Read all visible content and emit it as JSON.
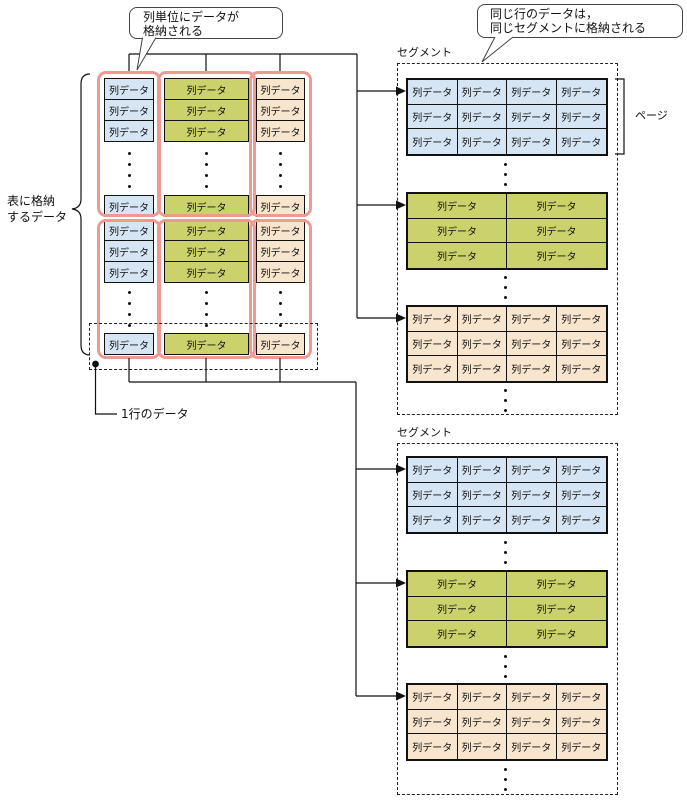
{
  "diagram": {
    "cell_label": "列データ",
    "page_label": "ページ",
    "row_label": "1行のデータ",
    "table_label": {
      "lines": [
        "表に格納",
        "するデータ"
      ]
    },
    "callout_column_storage": {
      "lines": [
        "列単位にデータが",
        "格納される"
      ]
    },
    "callout_segment_storage": {
      "lines": [
        "同じ行のデータは，",
        "同じセグメントに格納される"
      ]
    },
    "colors": {
      "column1": "#d5e5f4",
      "column2": "#cbd26b",
      "column3": "#f7e5cd",
      "highlight_outline": "#ef9a91",
      "line": "#111111"
    },
    "table": {
      "columns": [
        {
          "color_key": "column1"
        },
        {
          "color_key": "column2"
        },
        {
          "color_key": "column3"
        }
      ],
      "row_groups": [
        {
          "rows_shown_top": 3,
          "ellipsis": true,
          "rows_shown_bottom": 1
        },
        {
          "rows_shown_top": 3,
          "ellipsis": true,
          "rows_shown_bottom": 1
        }
      ]
    },
    "segments": [
      {
        "label": "セグメント",
        "has_page_bracket": true,
        "blocks": [
          {
            "color_key": "column1",
            "columns": 4,
            "rows": 3
          },
          {
            "color_key": "column2",
            "columns": 2,
            "rows": 3
          },
          {
            "color_key": "column3",
            "columns": 4,
            "rows": 3
          }
        ]
      },
      {
        "label": "セグメント",
        "has_page_bracket": false,
        "blocks": [
          {
            "color_key": "column1",
            "columns": 4,
            "rows": 3
          },
          {
            "color_key": "column2",
            "columns": 2,
            "rows": 3
          },
          {
            "color_key": "column3",
            "columns": 4,
            "rows": 3
          }
        ]
      }
    ]
  }
}
